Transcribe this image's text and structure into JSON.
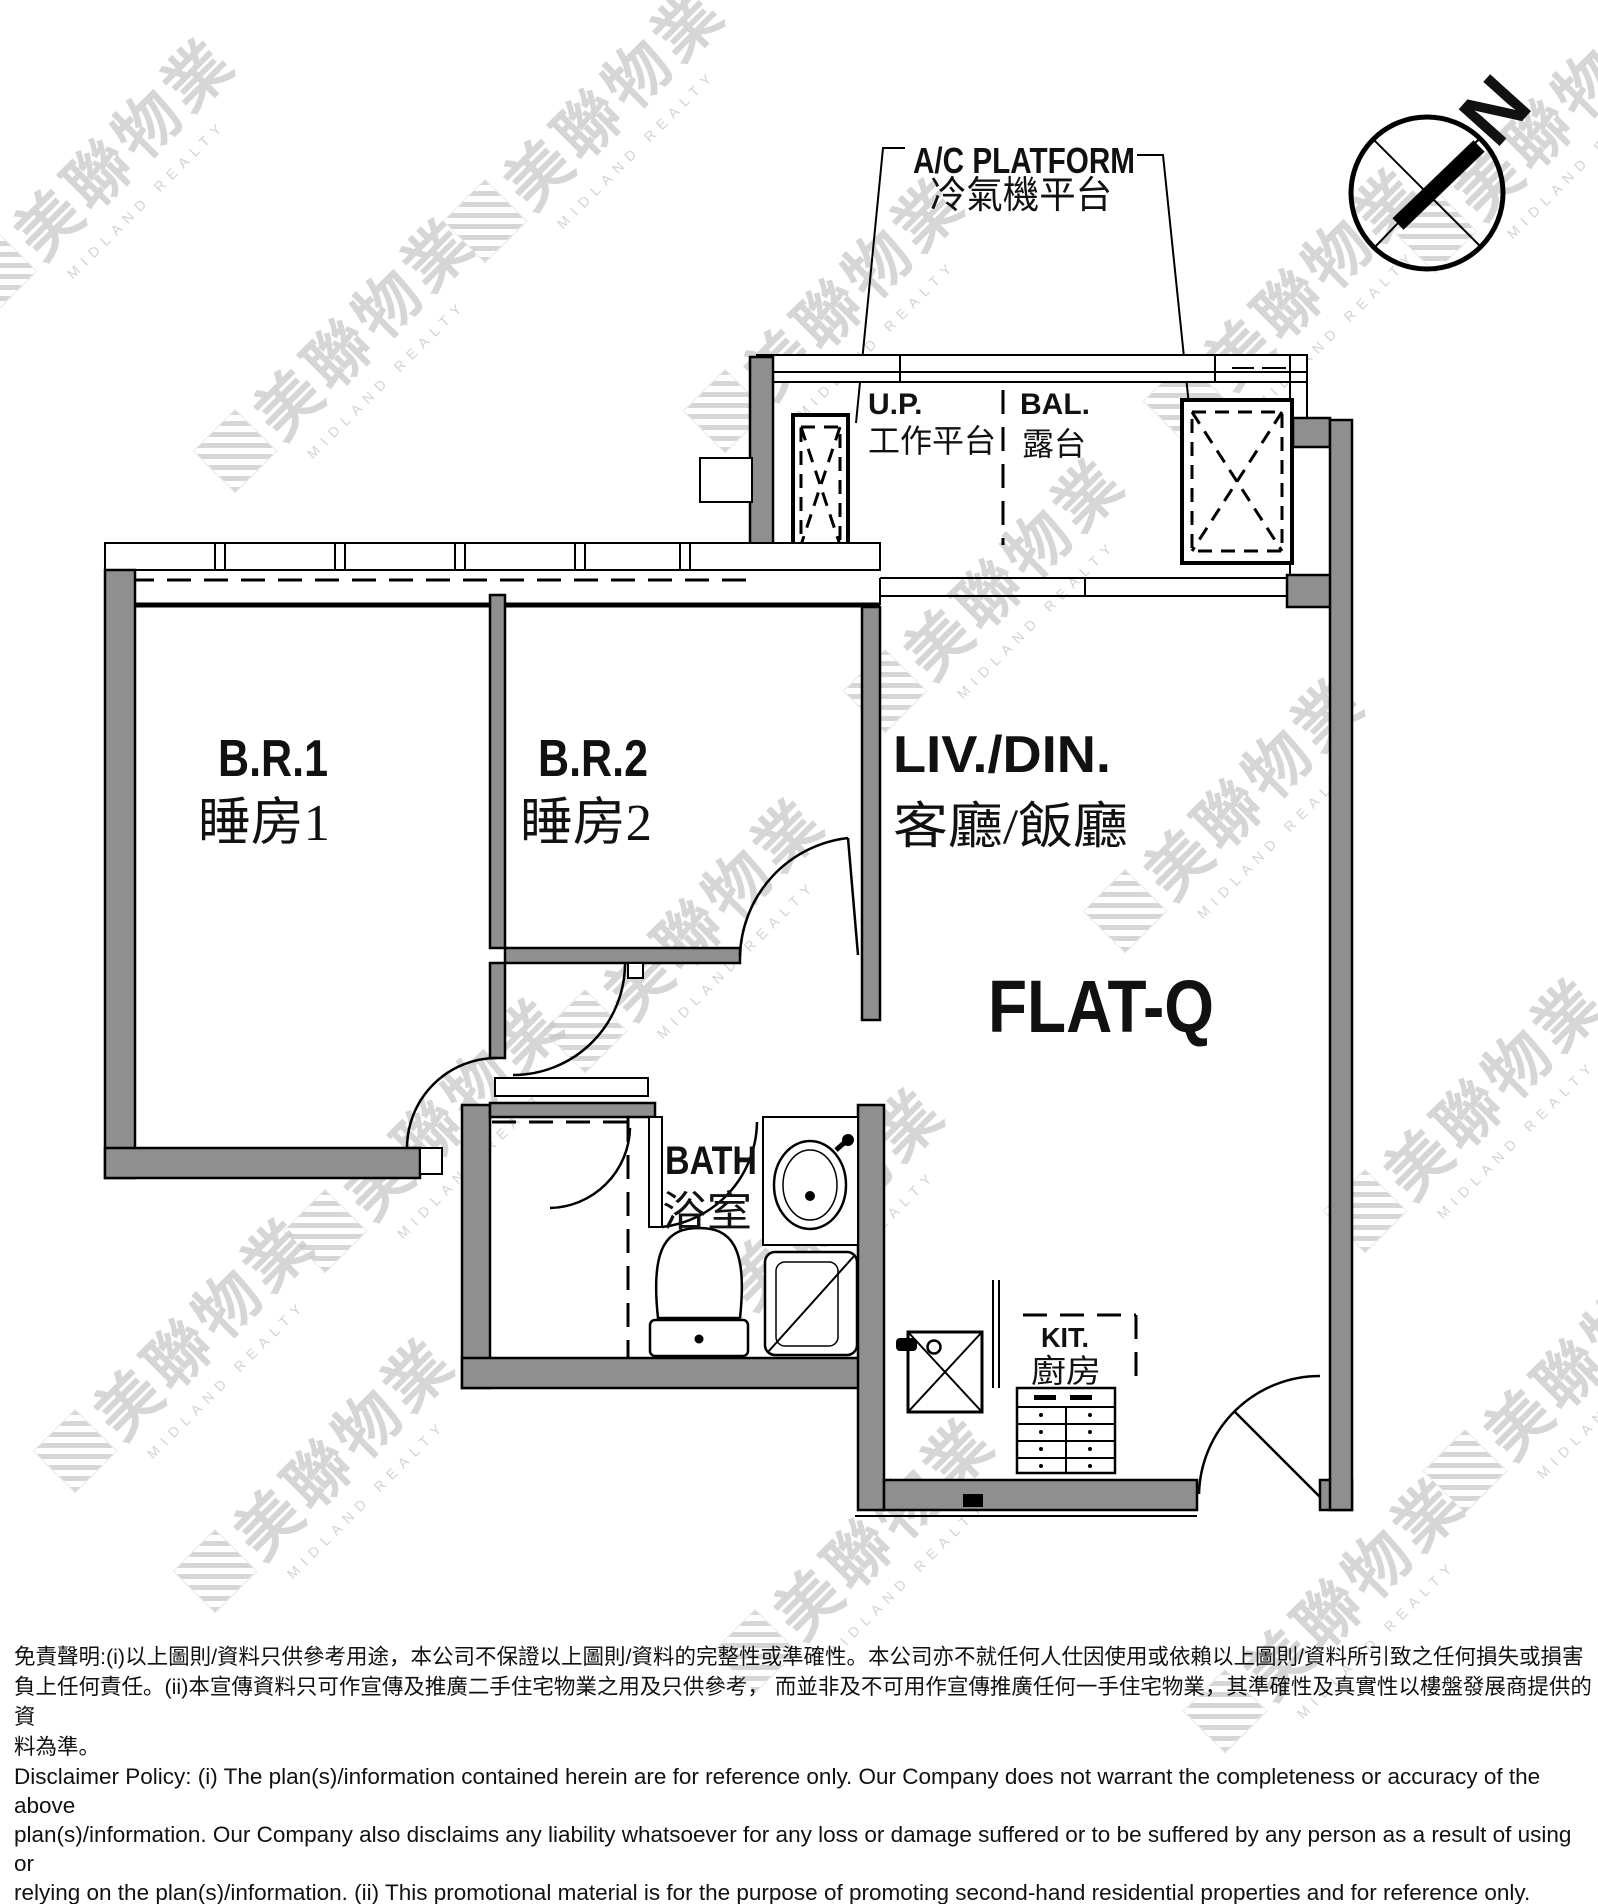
{
  "north_indicator": {
    "label": "N"
  },
  "labels": {
    "ac_platform": {
      "en": "A/C PLATFORM",
      "zh": "冷氣機平台"
    },
    "up": {
      "en": "U.P.",
      "zh": "工作平台"
    },
    "bal": {
      "en": "BAL.",
      "zh": "露台"
    },
    "br1": {
      "en": "B.R.1",
      "zh": "睡房1"
    },
    "br2": {
      "en": "B.R.2",
      "zh": "睡房2"
    },
    "livdin": {
      "en": "LIV./DIN.",
      "zh": "客廳/飯廳"
    },
    "flat": {
      "en": "FLAT-Q"
    },
    "bath": {
      "en": "BATH",
      "zh": "浴室"
    },
    "kit": {
      "en": "KIT.",
      "zh": "廚房"
    }
  },
  "watermark": {
    "zh": "美聯物業",
    "en": "MIDLAND REALTY"
  },
  "colors": {
    "wall_gray": "#8f8f8f",
    "line_black": "#111111",
    "watermark_gray": "#c9c9c9"
  },
  "disclaimer": {
    "zh_lines": [
      "免責聲明:(i)以上圖則/資料只供參考用途，本公司不保證以上圖則/資料的完整性或準確性。本公司亦不就任何人仕因使用或依賴以上圖則/資料所引致之任何損失或損害",
      "負上任何責任。(ii)本宣傳資料只可作宣傳及推廣二手住宅物業之用及只供參考， 而並非及不可用作宣傳推廣任何一手住宅物業，其準確性及真實性以樓盤發展商提供的資",
      "料為準。"
    ],
    "en_lines": [
      "Disclaimer Policy: (i) The plan(s)/information contained herein are for reference only. Our Company does not warrant the completeness or accuracy of the above",
      "plan(s)/information. Our Company also disclaims any liability whatsoever for any loss or damage suffered or to be suffered by any person as a result of using or",
      "relying on the plan(s)/information. (ii) This promotional material is for the purpose of promoting second-hand residential properties and for reference only.",
      "This promotional material shall not be used for the purpose of promoting first-hand residential properties. The accuracy and truth of the information contained",
      "in this promotional material shall be subject to information provided by the developers."
    ]
  }
}
